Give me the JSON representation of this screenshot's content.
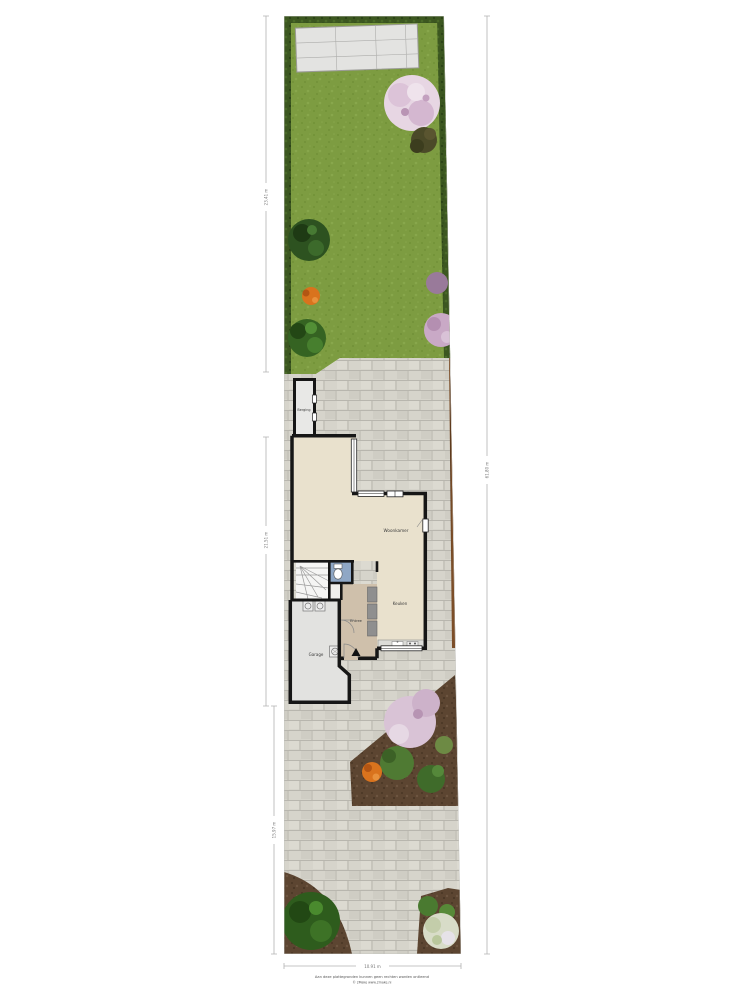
{
  "floorplan": {
    "type": "site-plan-ground-floor",
    "rooms": {
      "berging": "Berging",
      "woonkamer": "Woonkamer",
      "keuken": "Keuken",
      "entree": "Entree",
      "garage": "Garage"
    },
    "dimensions": {
      "garden_depth_left": "23.41 m",
      "house_depth_left": "21.51 m",
      "front_depth_left": "15.97 m",
      "total_depth_right": "61.80 m",
      "plot_width_bottom": "10.91 m"
    },
    "footer": {
      "disclaimer": "Aan deze plattegronden kunnen geen rechten worden ontleend",
      "copyright": "© 2Make www.2make.nl"
    },
    "colors": {
      "lawn": "#7d9c41",
      "hedge": "#3c5720",
      "paving": "#d6d4cb",
      "soil": "#5c4531",
      "fence": "#7c4e28",
      "floor_cream": "#e9e1cd",
      "floor_entree": "#cfc0ab",
      "floor_garage": "#e2e2e0",
      "toilet_floor": "#8fa7c5",
      "wall": "#161616"
    }
  }
}
